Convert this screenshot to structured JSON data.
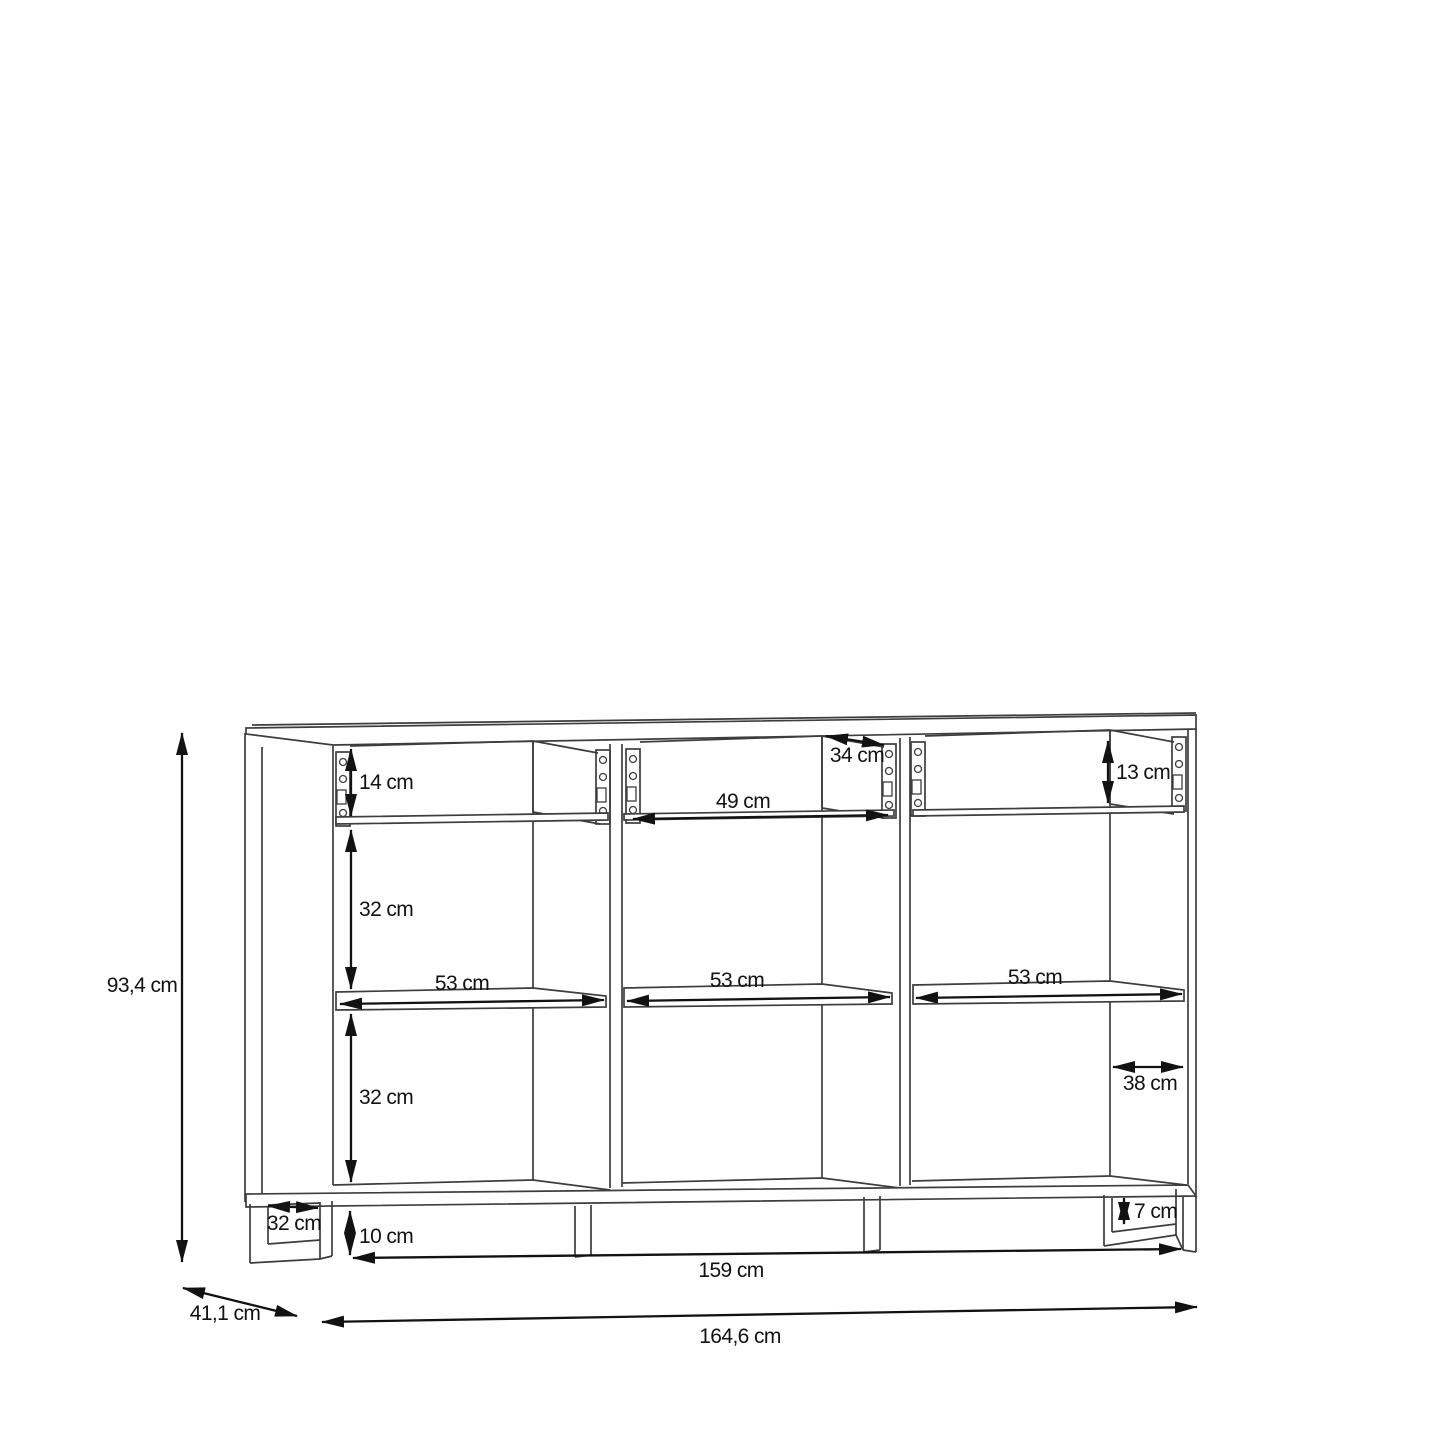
{
  "drawing": {
    "kind": "sideboard technical dimension drawing",
    "unit": "cm",
    "overall": {
      "height": "93,4 cm",
      "width": "164,6 cm",
      "depth": "41,1 cm"
    },
    "base": {
      "width": "159 cm",
      "plinth_height_left": "10 cm",
      "plinth_height_right": "7 cm",
      "plinth_depth": "32 cm"
    },
    "drawers": {
      "left_inner_height": "14 cm",
      "right_inner_height": "13 cm",
      "inner_width": "49 cm",
      "inner_depth": "34 cm"
    },
    "compartments": {
      "upper_height": "32 cm",
      "lower_height": "32 cm"
    },
    "shelves": {
      "left_width": "53 cm",
      "middle_width": "53 cm",
      "right_width": "53 cm",
      "right_depth": "38 cm"
    }
  }
}
